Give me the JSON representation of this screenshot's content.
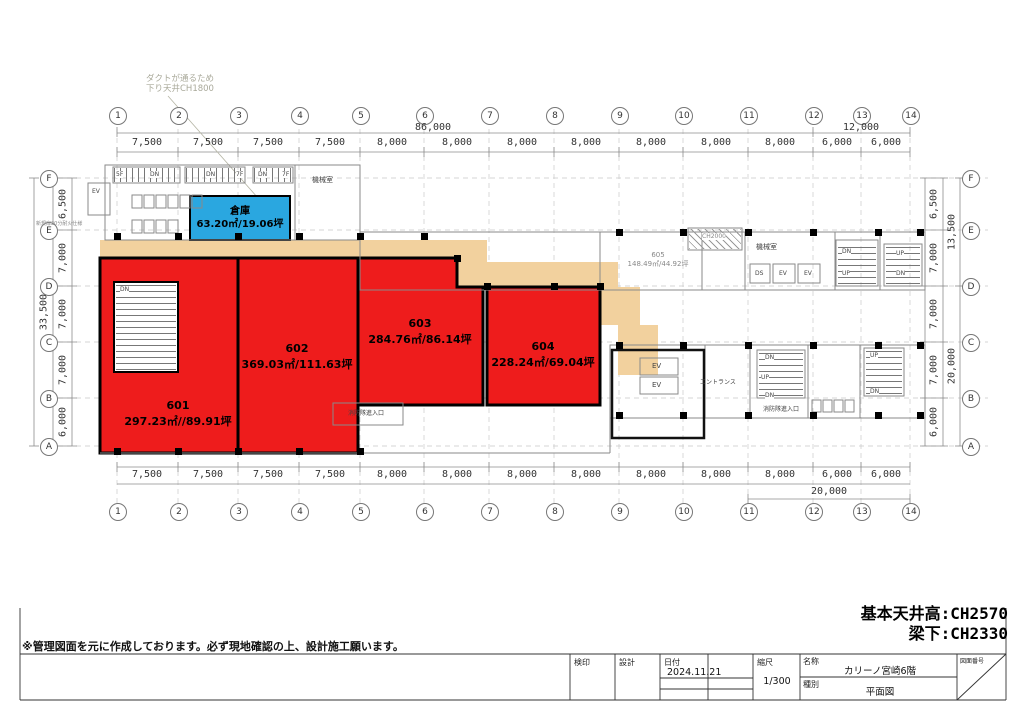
{
  "annotation": {
    "line1": "ダクトが通るため",
    "line2": "下り天井CH1800"
  },
  "grid": {
    "cols": [
      "1",
      "2",
      "3",
      "4",
      "5",
      "6",
      "7",
      "8",
      "9",
      "10",
      "11",
      "12",
      "13",
      "14"
    ],
    "rows": [
      "F",
      "E",
      "D",
      "C",
      "B",
      "A"
    ]
  },
  "dims": {
    "top": [
      "7,500",
      "7,500",
      "7,500",
      "7,500",
      "8,000",
      "8,000",
      "8,000",
      "8,000",
      "8,000",
      "8,000",
      "8,000",
      "6,000",
      "6,000"
    ],
    "bottom": [
      "7,500",
      "7,500",
      "7,500",
      "7,500",
      "8,000",
      "8,000",
      "8,000",
      "8,000",
      "8,000",
      "8,000",
      "8,000",
      "6,000",
      "6,000"
    ],
    "left": [
      "6,500",
      "7,000",
      "7,000",
      "7,000",
      "6,000"
    ],
    "right": [
      "6,500",
      "7,000",
      "7,000",
      "7,000",
      "6,000"
    ],
    "top_total": "86,000",
    "top_right": "12,000",
    "bottom_right": "20,000",
    "left_total": "33,500",
    "right_upper": "13,500",
    "right_lower": "20,000"
  },
  "rooms": {
    "r601": {
      "no": "601",
      "area": "297.23㎡//89.91坪"
    },
    "r602": {
      "no": "602",
      "area": "369.03㎡/111.63坪"
    },
    "r603": {
      "no": "603",
      "area": "284.76㎡/86.14坪"
    },
    "r604": {
      "no": "604",
      "area": "228.24㎡/69.04坪"
    },
    "r605": {
      "no": "605",
      "area": "148.49㎡/44.92坪"
    },
    "storage": {
      "name": "倉庫",
      "area": "63.20㎡/19.06坪"
    }
  },
  "plan_labels": {
    "ev": "EV",
    "up": "UP",
    "dn": "DN",
    "ds": "DS",
    "f5": "5F",
    "f7": "7F",
    "machine": "機械室",
    "ch2000": "CH2000",
    "entrance": "エントランス",
    "fire_entry": "消防隊進入口",
    "door_note": "新規扉20分耐火仕様"
  },
  "notes": {
    "ceiling": "基本天井高:CH2570",
    "beam": "梁下:CH2330",
    "disclaimer": "※管理図面を元に作成しております。必ず現地確認の上、設計施工願います。"
  },
  "titleblock": {
    "check_label": "検印",
    "design_label": "設計",
    "date_label": "日付",
    "date": "2024.11.21",
    "scale_label": "縮尺",
    "scale": "1/300",
    "name_label": "名称",
    "name": "カリーノ宮崎6階",
    "type_label": "種別",
    "type": "平面図",
    "dwgno_label": "図面番号"
  },
  "colors": {
    "room_fill": "#ee1c1c",
    "storage_fill": "#2aa7e0",
    "corridor_fill": "#f2d19e"
  }
}
